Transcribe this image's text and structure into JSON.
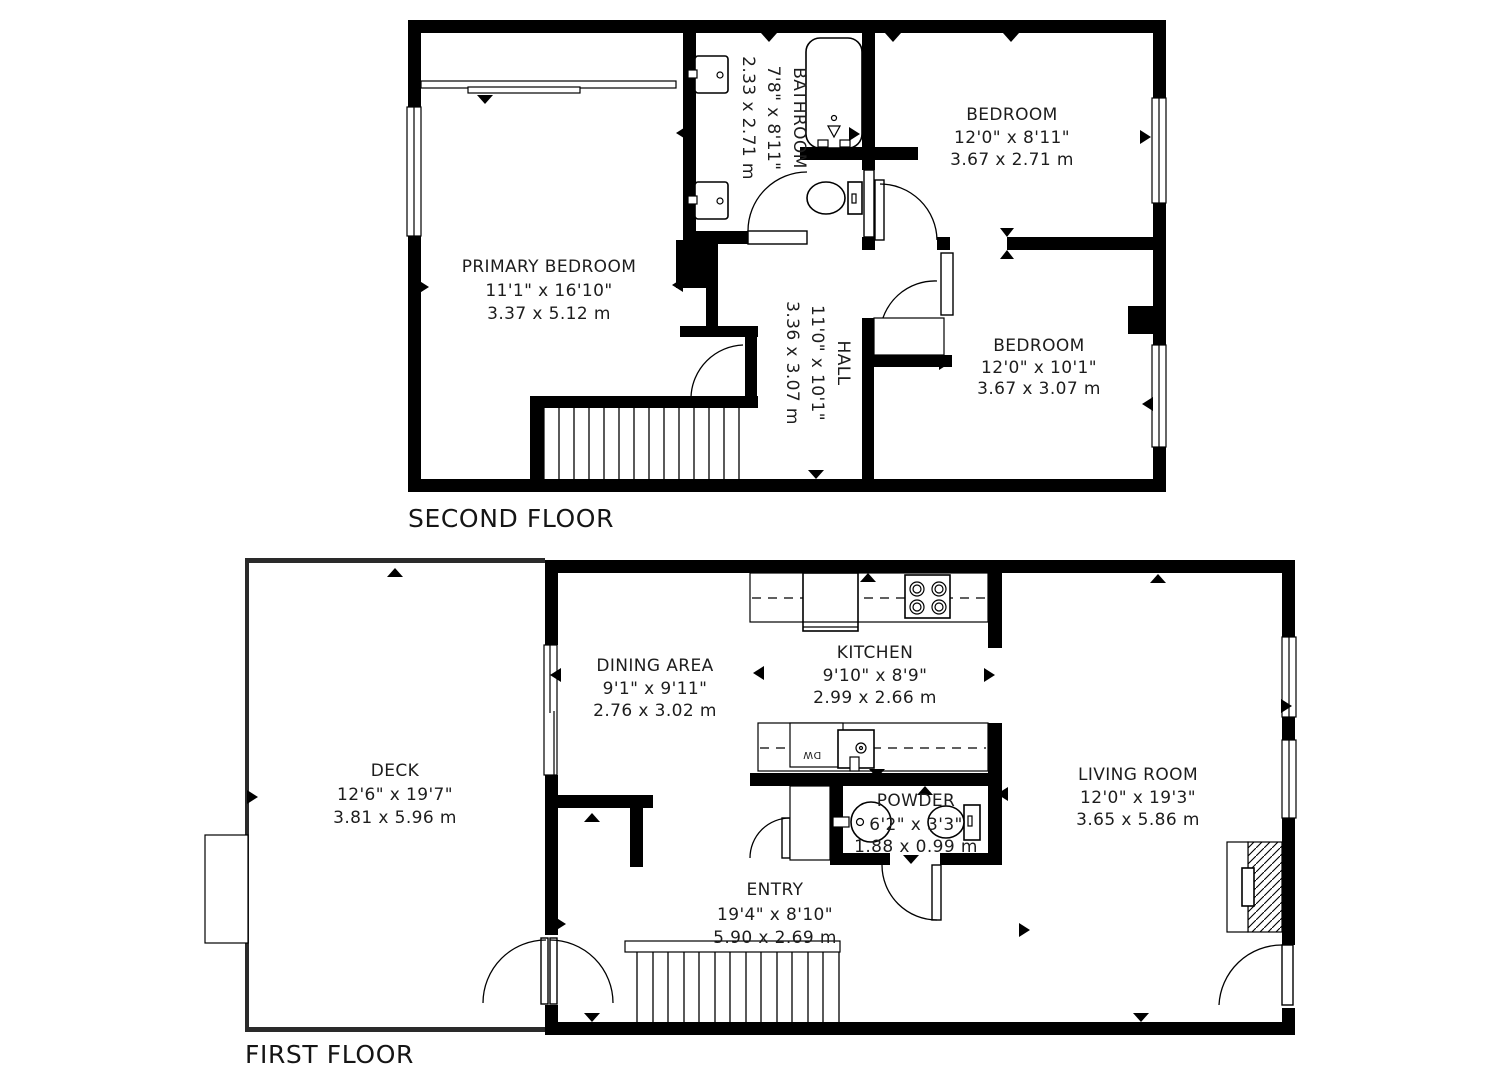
{
  "colors": {
    "wall": "#000000",
    "background": "#ffffff",
    "text": "#1d1d1d"
  },
  "floors": [
    {
      "label": "SECOND FLOOR",
      "rooms": [
        {
          "name": "PRIMARY BEDROOM",
          "dims_ft": "11'1\" x 16'10\"",
          "dims_m": "3.37 x 5.12 m"
        },
        {
          "name": "BATHROOM",
          "dims_ft": "7'8\" x 8'11\"",
          "dims_m": "2.33 x 2.71 m"
        },
        {
          "name": "BEDROOM",
          "dims_ft": "12'0\" x 8'11\"",
          "dims_m": "3.67 x 2.71 m"
        },
        {
          "name": "HALL",
          "dims_ft": "11'0\" x 10'1\"",
          "dims_m": "3.36 x 3.07 m"
        },
        {
          "name": "BEDROOM",
          "dims_ft": "12'0\" x 10'1\"",
          "dims_m": "3.67 x 3.07 m"
        }
      ]
    },
    {
      "label": "FIRST FLOOR",
      "rooms": [
        {
          "name": "DECK",
          "dims_ft": "12'6\" x 19'7\"",
          "dims_m": "3.81 x 5.96 m"
        },
        {
          "name": "DINING AREA",
          "dims_ft": "9'1\" x 9'11\"",
          "dims_m": "2.76 x 3.02 m"
        },
        {
          "name": "KITCHEN",
          "dims_ft": "9'10\" x 8'9\"",
          "dims_m": "2.99 x 2.66 m"
        },
        {
          "name": "POWDER",
          "dims_ft": "6'2\" x 3'3\"",
          "dims_m": "1.88 x 0.99 m"
        },
        {
          "name": "ENTRY",
          "dims_ft": "19'4\" x 8'10\"",
          "dims_m": "5.90 x 2.69 m"
        },
        {
          "name": "LIVING ROOM",
          "dims_ft": "12'0\" x 19'3\"",
          "dims_m": "3.65 x 5.86 m"
        }
      ]
    }
  ],
  "fixtures": {
    "dishwasher_label": "DW"
  }
}
